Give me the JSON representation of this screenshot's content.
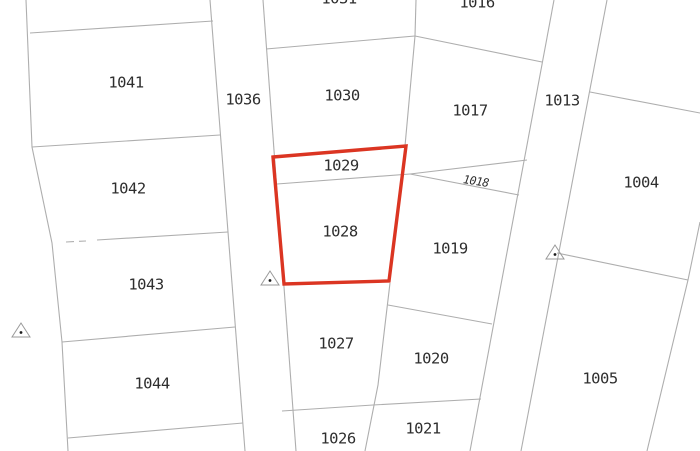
{
  "app": {
    "title": "Cadastral parcel map"
  },
  "map": {
    "colors": {
      "background": "#ffffff",
      "boundary": "#aeaeae",
      "label": "#2e2e2e",
      "highlight": "#db3522",
      "marker_outline": "#9a9a9a",
      "marker_dot": "#1a1a1a"
    },
    "selected_parcel": {
      "labels": [
        "1029",
        "1028"
      ],
      "outline_points": "273,157 406,146 389,281 284,284"
    },
    "parcel_labels": [
      {
        "id": "1041",
        "x": 126,
        "y": 82
      },
      {
        "id": "1042",
        "x": 128,
        "y": 188
      },
      {
        "id": "1043",
        "x": 146,
        "y": 284
      },
      {
        "id": "1044",
        "x": 152,
        "y": 383
      },
      {
        "id": "1036",
        "x": 243,
        "y": 99
      },
      {
        "id": "1031",
        "x": 339,
        "y": -2,
        "clipped": true
      },
      {
        "id": "1030",
        "x": 342,
        "y": 95
      },
      {
        "id": "1029",
        "x": 341,
        "y": 165
      },
      {
        "id": "1028",
        "x": 340,
        "y": 231
      },
      {
        "id": "1027",
        "x": 336,
        "y": 343
      },
      {
        "id": "1026",
        "x": 338,
        "y": 438
      },
      {
        "id": "1016",
        "x": 477,
        "y": 2,
        "clipped": true
      },
      {
        "id": "1017",
        "x": 470,
        "y": 110
      },
      {
        "id": "1018",
        "x": 476,
        "y": 181,
        "italic": true,
        "rotate": 9,
        "small": true
      },
      {
        "id": "1019",
        "x": 450,
        "y": 248
      },
      {
        "id": "1020",
        "x": 431,
        "y": 358
      },
      {
        "id": "1021",
        "x": 423,
        "y": 428
      },
      {
        "id": "1013",
        "x": 562,
        "y": 100
      },
      {
        "id": "1004",
        "x": 641,
        "y": 182
      },
      {
        "id": "1005",
        "x": 600,
        "y": 378
      }
    ],
    "boundaries": [
      {
        "name": "west-outer-boundary",
        "points": "26,0 32,147 52,243 62,342 68,451"
      },
      {
        "name": "parcel-1041-north",
        "points": "30,33 213,21"
      },
      {
        "name": "parcel-1041-1042",
        "points": "32,147 220,135"
      },
      {
        "name": "parcel-1042-1043",
        "points": "97,240 228,232"
      },
      {
        "name": "parcel-1043-1044",
        "points": "62,342 235,327"
      },
      {
        "name": "parcel-1044-south",
        "points": "68,438 243,423"
      },
      {
        "name": "road-1036-west-edge",
        "points": "210,0 245,451"
      },
      {
        "name": "road-1036-east-edge",
        "points": "263,0 296,451"
      },
      {
        "name": "parcel-1031-1030",
        "points": "266,49 415,36"
      },
      {
        "name": "parcel-1031-1016",
        "points": "416,0 415,36"
      },
      {
        "name": "parcel-1016-1017",
        "points": "415,36 542,62"
      },
      {
        "name": "parcel-1030-1017",
        "points": "415,36 405,146"
      },
      {
        "name": "parcel-1029-1028",
        "points": "277,184 410,174"
      },
      {
        "name": "parcel-1018-wedge-north",
        "points": "410,174 527,160"
      },
      {
        "name": "parcel-1018-wedge-south",
        "points": "410,174 519,195"
      },
      {
        "name": "parcel-1019-1020",
        "points": "388,305 492,324"
      },
      {
        "name": "parcel-1027-1020",
        "points": "390,283 385,325 378,385 365,451"
      },
      {
        "name": "parcel-1026-1021-north",
        "points": "282,411 373,405 481,399"
      },
      {
        "name": "road-1013-west-edge",
        "points": "554,0 470,451"
      },
      {
        "name": "road-1013-east-edge",
        "points": "607,0 521,451"
      },
      {
        "name": "parcel-1004-north",
        "points": "590,92 700,113"
      },
      {
        "name": "parcel-1004-1005",
        "points": "557,253 688,280"
      },
      {
        "name": "east-outer-boundary",
        "points": "700,222 688,280 647,451"
      }
    ],
    "dashed_boundaries": [
      {
        "name": "parcel-1042-1043-dashed",
        "points": "66,242 86,241"
      }
    ],
    "survey_markers": [
      {
        "x": 21,
        "y": 331
      },
      {
        "x": 270,
        "y": 279
      },
      {
        "x": 555,
        "y": 253
      }
    ]
  }
}
